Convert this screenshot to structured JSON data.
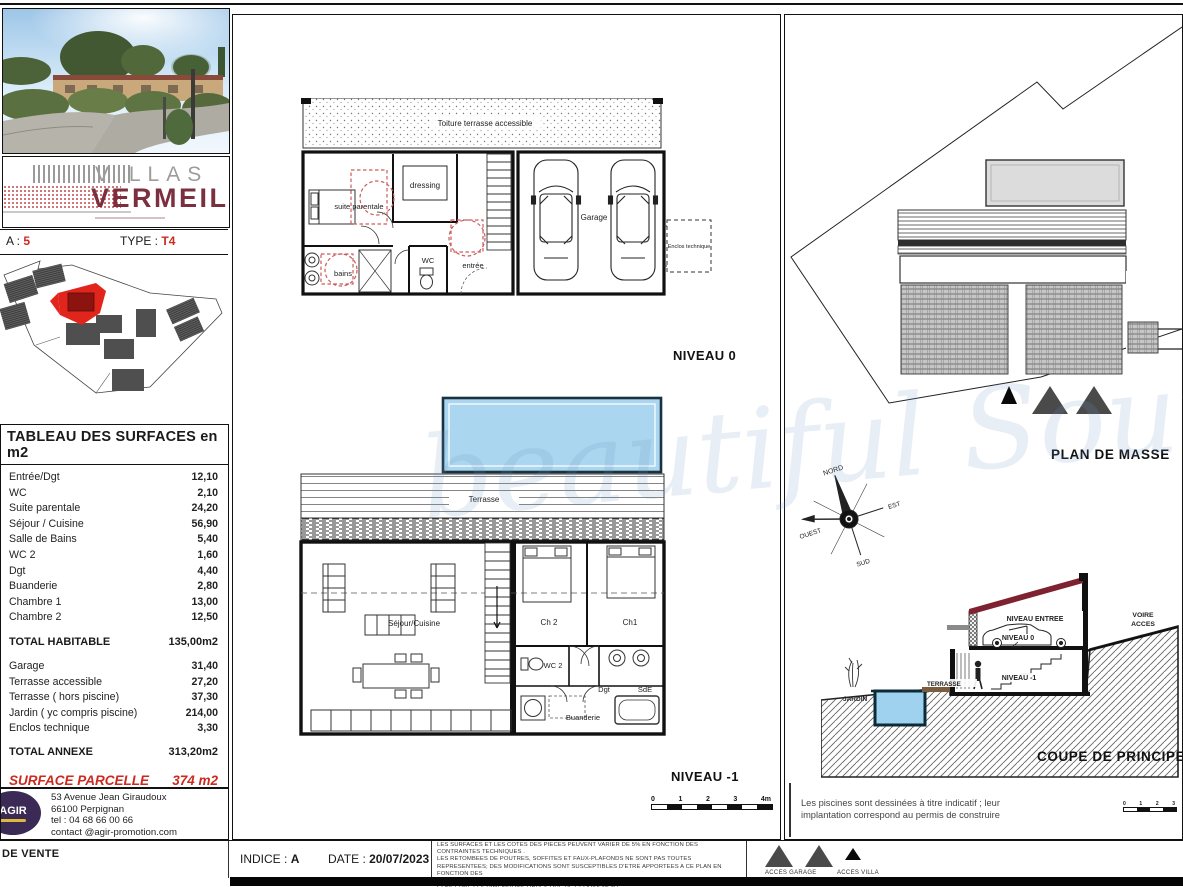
{
  "brand": {
    "line1": "VILLAS",
    "line2": "VERMEIL"
  },
  "header": {
    "villa_label": "A :",
    "villa_value": "5",
    "type_label": "TYPE :",
    "type_value": "T4"
  },
  "surfaces": {
    "title": "TABLEAU DES SURFACES en m2",
    "rows": [
      {
        "label": "Entrée/Dgt",
        "value": "12,10"
      },
      {
        "label": "WC",
        "value": "2,10"
      },
      {
        "label": "Suite parentale",
        "value": "24,20"
      },
      {
        "label": "Séjour / Cuisine",
        "value": "56,90"
      },
      {
        "label": "Salle de Bains",
        "value": "5,40"
      },
      {
        "label": "WC 2",
        "value": "1,60"
      },
      {
        "label": "Dgt",
        "value": "4,40"
      },
      {
        "label": "Buanderie",
        "value": "2,80"
      },
      {
        "label": "Chambre 1",
        "value": "13,00"
      },
      {
        "label": "Chambre 2",
        "value": "12,50"
      }
    ],
    "total_habitable": {
      "label": "TOTAL HABITABLE",
      "value": "135,00m2"
    },
    "annex_rows": [
      {
        "label": "Garage",
        "value": "31,40"
      },
      {
        "label": "Terrasse accessible",
        "value": "27,20"
      },
      {
        "label": "Terrasse ( hors piscine)",
        "value": "37,30"
      },
      {
        "label": "Jardin ( yc compris piscine)",
        "value": "214,00"
      },
      {
        "label": "Enclos technique",
        "value": "3,30"
      }
    ],
    "total_annexe": {
      "label": "TOTAL ANNEXE",
      "value": "313,20m2"
    },
    "parcelle": {
      "label": "SURFACE PARCELLE",
      "value": "374 m2"
    }
  },
  "contact": {
    "logo": "AGIR",
    "lines": [
      "53 Avenue Jean Giraudoux",
      "66100 Perpignan",
      "tel : 04 68 66 00 66",
      "contact @agir-promotion.com"
    ]
  },
  "plans": {
    "niveau0": {
      "title": "NIVEAU 0",
      "toiture": "Toiture terrasse accessible",
      "suite": "suite parentale",
      "dressing": "dressing",
      "wc": "WC",
      "entree": "entrée",
      "bains": "bains",
      "garage": "Garage",
      "enclos": "Enclos technique"
    },
    "niveau1": {
      "title": "NIVEAU -1",
      "terrasse": "Terrasse",
      "sejour": "Séjour/Cuisine",
      "ch2": "Ch 2",
      "ch1": "Ch1",
      "wc2": "WC 2",
      "dgt": "Dgt",
      "sde": "SdE",
      "buanderie": "Buanderie"
    },
    "scale": {
      "t0": "0",
      "t1": "1",
      "t2": "2",
      "t3": "3",
      "t4": "4m"
    }
  },
  "masse": {
    "title": "PLAN DE MASSE"
  },
  "compass": {
    "n": "NORD",
    "e": "EST",
    "s": "SUD",
    "w": "OUEST"
  },
  "coupe": {
    "title": "COUPE DE PRINCIPE",
    "jardin": "JARDIN",
    "terrasse": "TERRASSE",
    "niveau_entree": "NIVEAU ENTREE",
    "niveau0": "NIVEAU 0",
    "niveau1": "NIVEAU -1",
    "voirie1": "VOIRE",
    "voirie2": "ACCES"
  },
  "notes": {
    "piscine1": "Les piscines sont dessinées à titre indicatif ; leur",
    "piscine2": "implantation correspond au permis de construire"
  },
  "titleblock": {
    "sheet_label": "DE VENTE",
    "indice_label": "INDICE :",
    "indice_value": "A",
    "date_label": "DATE :",
    "date_value": "20/07/2023",
    "disclaimer": [
      "LES SURFACES ET LES COTES DES PIECES PEUVENT VARIER DE 5% EN FONCTION DES",
      "CONTRAINTES TECHNIQUES .",
      "LES RETOMBEES DE POUTRES, SOFFITES ET FAUX-PLAFONDS NE SONT PAS TOUTES REPRESENTEES; DES MODIFICATIONS SONT SUSCEPTIBLES D'ETRE APPORTEES A CE PLAN EN FONCTION DES",
      "CONTRAINTES TECHNIQUES OU REGLEMENTAIRES DE LA CONSTRUCTION, TANT EN CE QUI",
      "CONCERNE LES DIMENSIONS LIBRES QUE DE L'EQUIPEMENT"
    ]
  },
  "legend": {
    "garage": "ACCES GARAGE",
    "villa": "ACCES VILLA"
  },
  "watermark": "beautiful South",
  "colors": {
    "brand_red": "#7b2f3f",
    "accent_red": "#cc2a1e",
    "pool_blue": "#aad6ef",
    "logo_purple": "#3a2a55"
  }
}
